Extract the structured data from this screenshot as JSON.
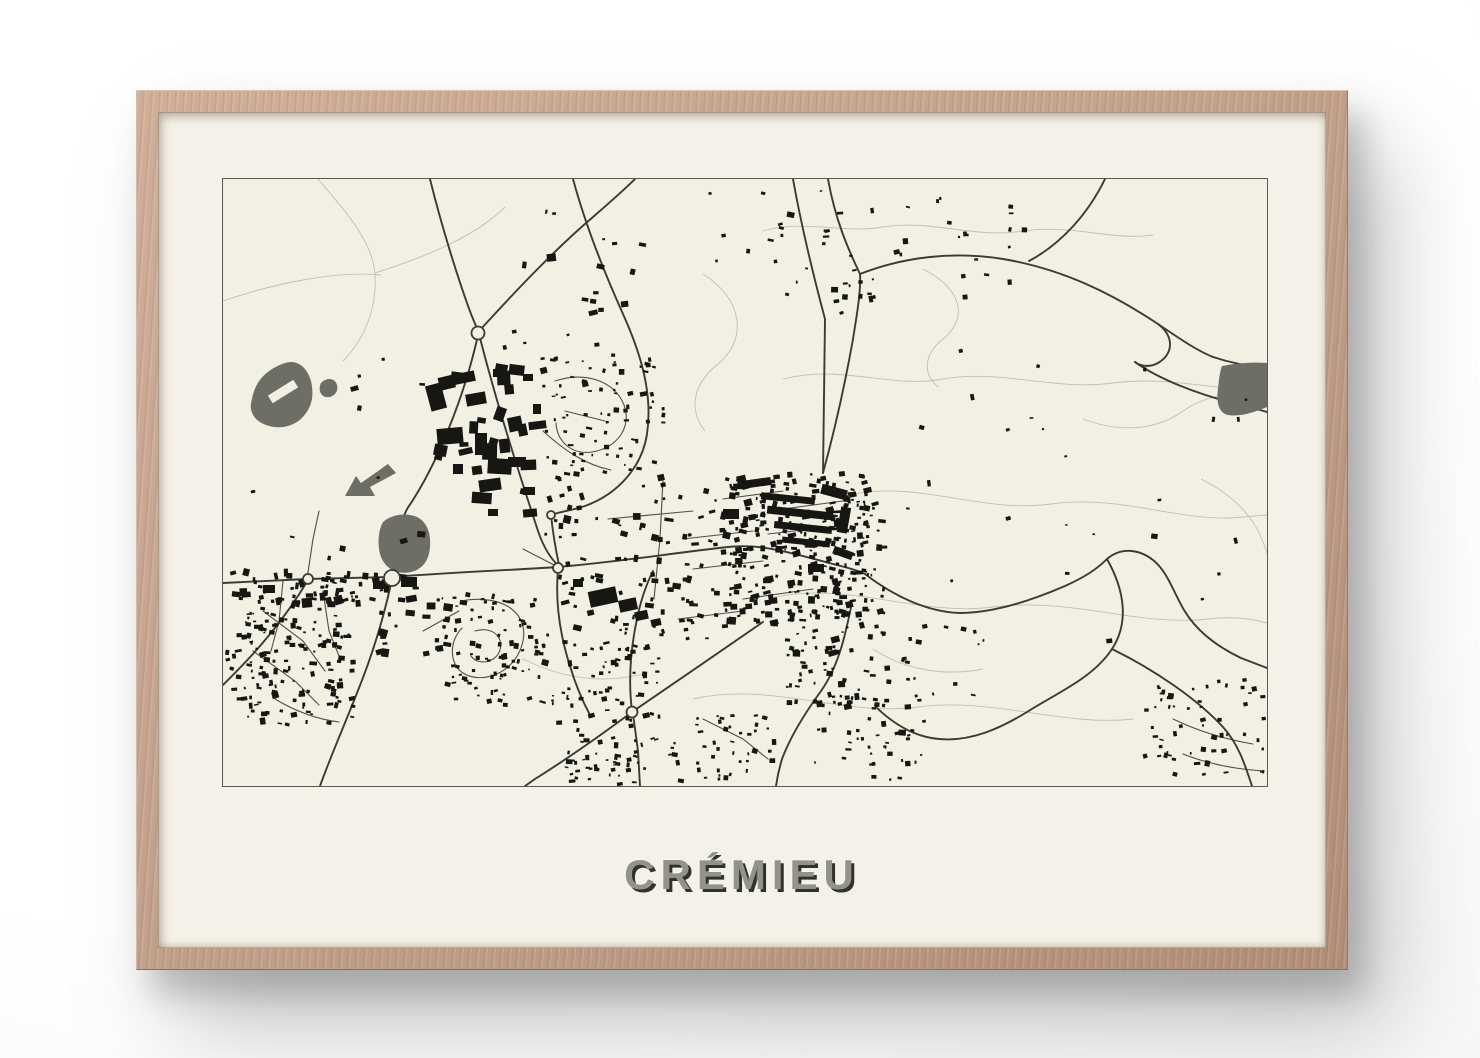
{
  "poster": {
    "title": "CRÉMIEU"
  },
  "colors": {
    "matte": "#f4f2e8",
    "map_bg": "#f2efe3",
    "border": "#5a594f",
    "ink": "#161613",
    "road": "#3b3a34",
    "road_minor": "#514f48",
    "contour": "#c1bfb3",
    "water": "#6e6d66",
    "title_fill": "#94938a",
    "title_shadow": "#32312c",
    "frame_wood": "#c3a28c"
  },
  "map": {
    "width": 1044,
    "height": 607,
    "roads_major": [
      "M 0 404 L 84 400 L 168 398 C 235 393 290 391 335 388 C 395 383 450 374 505 368 C 540 364 575 376 610 385 C 622 388 634 391 642 395",
      "M 207 0 C 218 45 235 100 248 135 L 255 152",
      "M 255 156 C 242 215 215 285 184 330 C 173 352 170 375 169 396",
      "M 256 155 C 275 230 298 300 315 352 C 322 372 330 382 336 387",
      "M 257 151 C 290 115 330 72 370 38 C 385 25 400 12 412 0",
      "M 350 0 C 363 48 382 95 400 135 C 418 175 430 215 424 255 C 419 288 395 315 362 327 C 350 331 336 333 328 336 C 330 355 333 372 336 386",
      "M 600 294 C 612 250 622 205 630 160 C 634 135 638 112 637 95",
      "M 637 95 C 680 78 730 72 780 80 C 840 90 890 115 935 145 C 960 162 975 172 990 178",
      "M 990 178 C 1005 183 1022 187 1044 189",
      "M 935 145 C 952 158 950 175 935 184 C 928 188 918 188 912 183",
      "M 912 183 C 935 200 975 215 1010 224 C 1022 227 1034 230 1044 233",
      "M 570 0 C 578 45 590 95 602 140 L 600 294",
      "M 605 0 C 612 40 625 70 637 95",
      "M 882 0 C 865 35 838 65 806 82",
      "M 642 395 C 672 418 705 433 737 434 C 772 434 812 420 842 407 C 862 398 874 390 884 380 C 898 368 916 370 930 381 C 944 392 950 412 961 431 C 974 453 995 468 1018 479 L 1044 489",
      "M 884 380 C 902 412 906 444 889 470 C 870 499 834 514 804 533 C 778 549 748 563 716 560 C 692 558 670 545 652 527",
      "M 889 470 C 932 491 974 520 1000 548 C 1016 566 1022 586 1029 607",
      "M 628 428 C 622 458 615 488 598 512 C 582 534 568 556 559 580 C 556 590 554 600 553 607",
      "M 409 533 C 450 505 498 472 540 443",
      "M 409 533 C 378 556 344 580 312 600 L 302 607",
      "M 410 535 L 415 572 L 417 607",
      "M 409 532 C 405 500 408 468 414 440 C 418 420 424 404 430 392",
      "M 169 400 C 161 438 149 477 134 514 C 121 547 107 579 97 607",
      "M 85 401 C 69 428 49 454 29 476 C 19 487 9 497 0 506",
      "M 335 390 C 332 424 337 456 347 487 C 352 504 359 521 367 536"
    ],
    "roads_minor": [
      "M 238 422 C 282 414 308 436 299 466 C 291 494 259 506 240 494 C 226 485 226 462 239 449",
      "M 252 452 C 268 447 281 457 277 471 C 273 484 255 487 248 477",
      "M 200 452 L 236 432",
      "M 332 202 C 362 192 392 202 401 226 C 409 247 395 269 369 273 C 348 276 334 262 333 244",
      "M 342 232 L 382 242",
      "M 320 252 C 342 272 363 286 388 291",
      "M 60 402 L 56 442 L 48 472",
      "M 40 432 L 80 462 L 102 492",
      "M 30 472 L 72 502 L 96 526",
      "M 100 412 L 106 452 L 118 482",
      "M 52 520 C 72 532 92 540 116 543",
      "M 440 300 L 437 360 L 431 420",
      "M 385 340 L 470 332",
      "M 460 360 L 530 352",
      "M 470 390 L 540 382",
      "M 500 320 L 560 312",
      "M 520 420 L 590 410",
      "M 455 440 L 520 432",
      "M 560 330 L 620 322",
      "M 545 355 L 615 347",
      "M 300 370 L 335 388",
      "M 84 400 L 90 360 L 96 332",
      "M 480 540 L 520 560 L 545 580",
      "M 950 540 C 975 552 1000 560 1030 565",
      "M 960 575 C 985 585 1010 590 1040 592"
    ],
    "contours": [
      "M 95 0 C 122 32 150 62 152 96 C 154 132 140 162 120 182",
      "M 0 122 C 58 102 118 92 158 96",
      "M 152 94 C 202 78 252 58 282 28",
      "M 480 95 C 520 120 525 160 495 185 C 470 205 465 230 482 252",
      "M 540 52 C 580 40 620 55 660 48 C 710 40 750 60 800 52 C 850 45 890 62 930 56",
      "M 560 200 C 620 185 668 210 720 200 C 780 190 830 212 890 204 C 950 196 1000 215 1044 208",
      "M 618 318 C 690 298 755 335 828 325 C 900 315 960 345 1020 338 L 1044 336",
      "M 545 420 C 620 400 695 438 770 428 C 850 418 915 448 985 440 C 1010 437 1030 440 1044 444",
      "M 470 520 C 545 502 620 538 695 528 C 770 518 840 548 910 540",
      "M 700 90 C 740 110 745 140 720 160 C 700 176 700 195 715 208",
      "M 860 240 C 900 255 935 250 960 232 C 985 215 1010 212 1035 222",
      "M 300 480 C 340 500 380 505 420 495",
      "M 650 470 C 680 490 720 498 760 490",
      "M 978 300 C 1008 315 1028 335 1038 358 C 1042 368 1044 372 1044 375"
    ],
    "ponds": [
      "M 29 220 C 32 202 44 190 62 184 C 74 180 84 188 88 202 C 91 216 90 228 78 240 C 64 252 44 250 33 240 C 27 233 27 227 29 220 Z",
      "M 98 204 C 104 198 112 199 114 206 C 116 213 110 219 103 218 C 97 217 95 210 98 204 Z",
      "M 165 285 L 173 294 L 147 308 L 152 317 L 122 317 L 133 297 L 138 304 Z",
      "M 160 343 C 168 336 182 333 194 338 C 204 343 208 354 207 368 C 206 381 200 390 188 393 C 174 396 163 390 158 378 C 154 367 155 352 160 343 Z",
      "M 999 187 C 1014 184 1030 183 1044 184 L 1044 228 C 1032 233 1018 238 1005 236 C 996 234 993 224 995 210 C 996 200 997 192 999 187 Z"
    ],
    "pond_holes": [
      {
        "x": 45,
        "y": 208,
        "w": 30,
        "h": 9,
        "r": -32
      }
    ],
    "blocks": [
      {
        "x": 205,
        "y": 205,
        "w": 16,
        "h": 26,
        "r": -15
      },
      {
        "x": 228,
        "y": 193,
        "w": 12,
        "h": 10,
        "r": 8
      },
      {
        "x": 243,
        "y": 214,
        "w": 20,
        "h": 12,
        "r": -10
      },
      {
        "x": 214,
        "y": 249,
        "w": 26,
        "h": 16,
        "r": -5
      },
      {
        "x": 252,
        "y": 254,
        "w": 12,
        "h": 22,
        "r": 0
      },
      {
        "x": 272,
        "y": 228,
        "w": 10,
        "h": 14,
        "r": 20
      },
      {
        "x": 285,
        "y": 278,
        "w": 18,
        "h": 10,
        "r": 0
      },
      {
        "x": 256,
        "y": 300,
        "w": 22,
        "h": 12,
        "r": -8
      },
      {
        "x": 300,
        "y": 308,
        "w": 12,
        "h": 8,
        "r": 0
      },
      {
        "x": 230,
        "y": 285,
        "w": 10,
        "h": 10,
        "r": 0
      },
      {
        "x": 295,
        "y": 245,
        "w": 9,
        "h": 12,
        "r": -12
      },
      {
        "x": 270,
        "y": 190,
        "w": 8,
        "h": 8,
        "r": 0
      },
      {
        "x": 300,
        "y": 195,
        "w": 10,
        "h": 7,
        "r": 0
      },
      {
        "x": 310,
        "y": 225,
        "w": 8,
        "h": 10,
        "r": 0
      },
      {
        "x": 300,
        "y": 330,
        "w": 14,
        "h": 8,
        "r": -5
      },
      {
        "x": 265,
        "y": 330,
        "w": 10,
        "h": 7,
        "r": 0
      },
      {
        "x": 366,
        "y": 410,
        "w": 28,
        "h": 16,
        "r": -12
      },
      {
        "x": 396,
        "y": 420,
        "w": 18,
        "h": 12,
        "r": -12
      },
      {
        "x": 412,
        "y": 432,
        "w": 13,
        "h": 9,
        "r": -12
      },
      {
        "x": 350,
        "y": 400,
        "w": 10,
        "h": 8,
        "r": 0
      },
      {
        "x": 428,
        "y": 440,
        "w": 10,
        "h": 7,
        "r": -12
      },
      {
        "x": 538,
        "y": 316,
        "w": 54,
        "h": 7,
        "r": 6
      },
      {
        "x": 544,
        "y": 330,
        "w": 66,
        "h": 8,
        "r": 6
      },
      {
        "x": 551,
        "y": 345,
        "w": 58,
        "h": 7,
        "r": 6
      },
      {
        "x": 559,
        "y": 360,
        "w": 48,
        "h": 6,
        "r": 6
      },
      {
        "x": 518,
        "y": 300,
        "w": 30,
        "h": 8,
        "r": -8
      },
      {
        "x": 598,
        "y": 308,
        "w": 26,
        "h": 10,
        "r": 15
      },
      {
        "x": 616,
        "y": 328,
        "w": 10,
        "h": 26,
        "r": 10
      },
      {
        "x": 500,
        "y": 330,
        "w": 16,
        "h": 10,
        "r": 0
      },
      {
        "x": 610,
        "y": 370,
        "w": 20,
        "h": 8,
        "r": 20
      },
      {
        "x": 585,
        "y": 385,
        "w": 16,
        "h": 8,
        "r": 0
      },
      {
        "x": 178,
        "y": 398,
        "w": 16,
        "h": 10,
        "r": 0
      },
      {
        "x": 150,
        "y": 402,
        "w": 12,
        "h": 8,
        "r": 0
      },
      {
        "x": 40,
        "y": 406,
        "w": 12,
        "h": 8,
        "r": 0
      }
    ],
    "clusters": [
      {
        "x": 202,
        "y": 185,
        "w": 112,
        "h": 152,
        "count": 24,
        "smin": 5,
        "smax": 14,
        "seed": 11
      },
      {
        "x": 317,
        "y": 172,
        "w": 122,
        "h": 132,
        "count": 85,
        "smin": 2,
        "smax": 4,
        "seed": 22
      },
      {
        "x": 320,
        "y": 300,
        "w": 195,
        "h": 160,
        "count": 110,
        "smin": 2.2,
        "smax": 5,
        "seed": 33
      },
      {
        "x": 497,
        "y": 292,
        "w": 148,
        "h": 152,
        "count": 240,
        "smin": 2,
        "smax": 5,
        "seed": 44
      },
      {
        "x": 600,
        "y": 320,
        "w": 60,
        "h": 115,
        "count": 70,
        "smin": 2,
        "smax": 4.5,
        "seed": 55
      },
      {
        "x": 560,
        "y": 430,
        "w": 105,
        "h": 95,
        "count": 70,
        "smin": 2.2,
        "smax": 5,
        "seed": 66
      },
      {
        "x": 590,
        "y": 515,
        "w": 115,
        "h": 85,
        "count": 45,
        "smin": 2,
        "smax": 4,
        "seed": 77
      },
      {
        "x": 22,
        "y": 400,
        "w": 112,
        "h": 145,
        "count": 125,
        "smin": 2,
        "smax": 4.5,
        "seed": 88
      },
      {
        "x": 5,
        "y": 388,
        "w": 190,
        "h": 38,
        "count": 45,
        "smin": 2.5,
        "smax": 6,
        "seed": 99
      },
      {
        "x": 0,
        "y": 428,
        "w": 65,
        "h": 105,
        "count": 40,
        "smin": 2,
        "smax": 4,
        "seed": 110
      },
      {
        "x": 150,
        "y": 408,
        "w": 75,
        "h": 65,
        "count": 20,
        "smin": 3,
        "smax": 7,
        "seed": 121
      },
      {
        "x": 217,
        "y": 413,
        "w": 102,
        "h": 112,
        "count": 90,
        "smin": 2,
        "smax": 4,
        "seed": 132
      },
      {
        "x": 325,
        "y": 448,
        "w": 110,
        "h": 115,
        "count": 70,
        "smin": 2,
        "smax": 4,
        "seed": 143
      },
      {
        "x": 430,
        "y": 535,
        "w": 125,
        "h": 65,
        "count": 45,
        "smin": 2,
        "smax": 4,
        "seed": 154
      },
      {
        "x": 340,
        "y": 560,
        "w": 90,
        "h": 45,
        "count": 40,
        "smin": 2,
        "smax": 4,
        "seed": 165
      },
      {
        "x": 560,
        "y": 8,
        "w": 125,
        "h": 125,
        "count": 30,
        "smin": 2,
        "smax": 4.5,
        "seed": 176
      },
      {
        "x": 700,
        "y": 18,
        "w": 100,
        "h": 105,
        "count": 16,
        "smin": 2,
        "smax": 4,
        "seed": 187
      },
      {
        "x": 477,
        "y": 10,
        "w": 85,
        "h": 75,
        "count": 10,
        "smin": 2.5,
        "smax": 4.5,
        "seed": 198
      },
      {
        "x": 260,
        "y": 8,
        "w": 165,
        "h": 160,
        "count": 20,
        "smin": 2.5,
        "smax": 5,
        "seed": 209
      },
      {
        "x": 650,
        "y": 140,
        "w": 390,
        "h": 320,
        "count": 26,
        "smin": 2,
        "smax": 4.5,
        "seed": 220
      },
      {
        "x": 920,
        "y": 498,
        "w": 122,
        "h": 100,
        "count": 58,
        "smin": 2,
        "smax": 4,
        "seed": 231
      },
      {
        "x": 0,
        "y": 178,
        "w": 200,
        "h": 200,
        "count": 12,
        "smin": 2.5,
        "smax": 5,
        "seed": 242
      },
      {
        "x": 640,
        "y": 440,
        "w": 120,
        "h": 80,
        "count": 20,
        "smin": 2,
        "smax": 4,
        "seed": 253
      }
    ],
    "roundabouts": [
      {
        "x": 85,
        "y": 400,
        "r": 5
      },
      {
        "x": 169,
        "y": 399,
        "r": 8
      },
      {
        "x": 255,
        "y": 154,
        "r": 6.5
      },
      {
        "x": 335,
        "y": 389,
        "r": 5
      },
      {
        "x": 328,
        "y": 336,
        "r": 4
      },
      {
        "x": 409,
        "y": 533,
        "r": 5.5
      }
    ]
  }
}
